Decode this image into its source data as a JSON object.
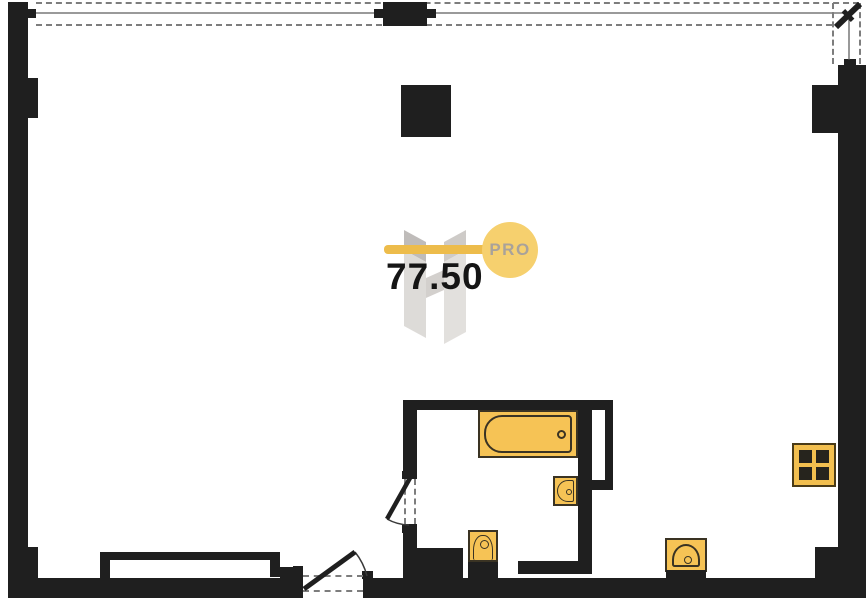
{
  "plan": {
    "area_label": "77.50",
    "logo_badge": "PRO",
    "colors": {
      "wall": "#1f1f1f",
      "fixture_fill": "#f6c355",
      "fixture_outline": "#3a3323",
      "logo_bar": "#edbc4b",
      "logo_circle": "#f6d06e",
      "logo_text": "#a9a29a",
      "dashed_line": "#7d7d7d",
      "glass_line": "#9a9a9a",
      "watermark": "#cfccc9"
    },
    "fixtures": [
      {
        "name": "bathtub"
      },
      {
        "name": "washbasin"
      },
      {
        "name": "toilet"
      },
      {
        "name": "kitchen-sink"
      },
      {
        "name": "stove-4-burner"
      },
      {
        "name": "radiator-cabinet"
      }
    ],
    "doors": [
      {
        "name": "entrance-door"
      },
      {
        "name": "bathroom-door"
      },
      {
        "name": "balcony-door"
      }
    ],
    "structure": [
      {
        "name": "window-band"
      },
      {
        "name": "column"
      },
      {
        "name": "vent-shaft"
      }
    ]
  }
}
